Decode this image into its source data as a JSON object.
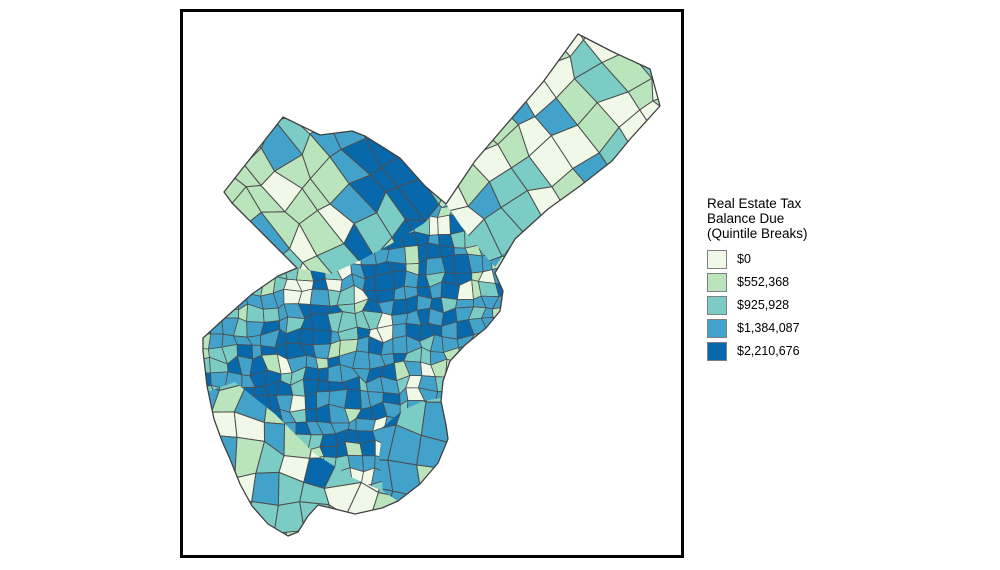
{
  "figure": {
    "background": "#ffffff",
    "frame_color": "#000000",
    "map": {
      "name": "philadelphia-census-tracts-choropleth",
      "tract_border_color": "#4d4d4d",
      "outline_color": "#404040",
      "palette": [
        "#f0f9e8",
        "#bae4bc",
        "#7bccc4",
        "#43a2ca",
        "#0868ac"
      ]
    },
    "legend": {
      "title_lines": [
        "Real Estate Tax",
        "Balance Due",
        "(Quintile Breaks)"
      ],
      "items": [
        {
          "label": "$0",
          "color": "#f0f9e8"
        },
        {
          "label": "$552,368",
          "color": "#bae4bc"
        },
        {
          "label": "$925,928",
          "color": "#7bccc4"
        },
        {
          "label": "$1,384,087",
          "color": "#43a2ca"
        },
        {
          "label": "$2,210,676",
          "color": "#0868ac"
        }
      ]
    }
  },
  "chart_data": {
    "type": "choropleth",
    "title": "Real Estate Tax Balance Due (Quintile Breaks)",
    "classification": "quintile breaks",
    "legend_position": "right",
    "classes": [
      {
        "break_label": "$0",
        "color": "#f0f9e8"
      },
      {
        "break_label": "$552,368",
        "color": "#bae4bc"
      },
      {
        "break_label": "$925,928",
        "color": "#7bccc4"
      },
      {
        "break_label": "$1,384,087",
        "color": "#43a2ca"
      },
      {
        "break_label": "$2,210,676",
        "color": "#0868ac"
      }
    ]
  }
}
